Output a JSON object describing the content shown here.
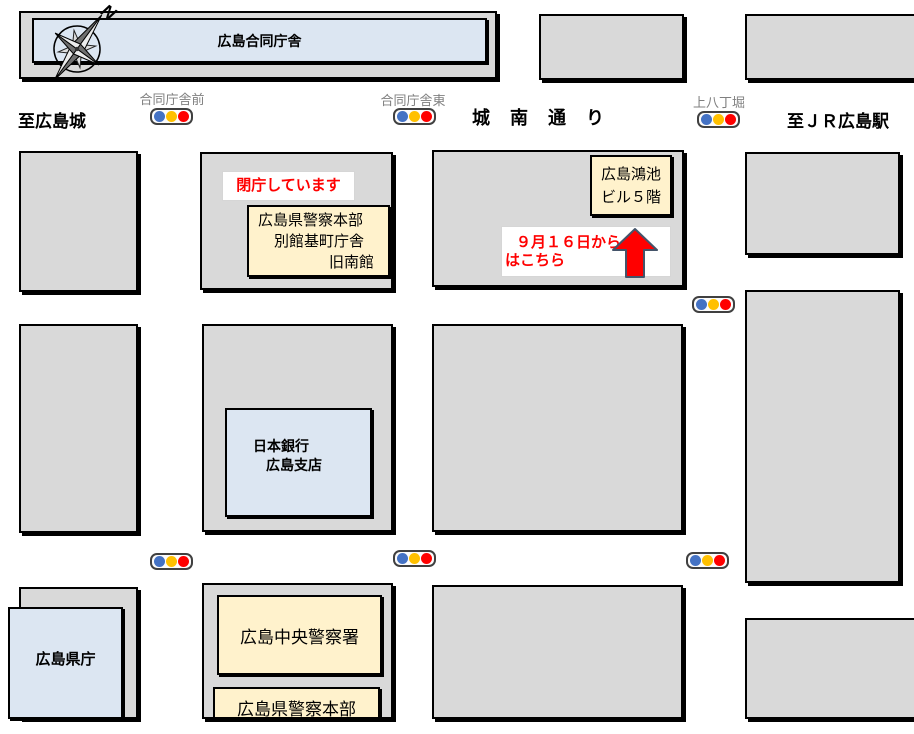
{
  "compass": {
    "north": "N"
  },
  "buildings": {
    "godochosha": "広島合同庁舎",
    "kyu_minamikan": {
      "line1": "広島県警察本部",
      "line2": "別館基町庁舎",
      "line3": "旧南館"
    },
    "konoike_bldg": {
      "line1": "広島鴻池",
      "line2": "ビル５階"
    },
    "nihon_ginko": {
      "line1": "日本銀行",
      "line2": "広島支店"
    },
    "kencho": "広島県庁",
    "chuo_keisatsusho": "広島中央警察署",
    "keisatsu_honbu": "広島県警察本部"
  },
  "notices": {
    "closed": "閉庁しています",
    "from_sep16_line1": "９月１６日から",
    "from_sep16_line2": "はこちら"
  },
  "roads": {
    "to_hiroshima_castle": "至広島城",
    "jonan_dori": "城　南　通　り",
    "to_jr_hiroshima_sta": "至ＪＲ広島駅"
  },
  "signals": {
    "godochosha_mae": "合同庁舎前",
    "godochosha_higashi": "合同庁舎東",
    "kami_hatchobori": "上八丁堀"
  },
  "colors": {
    "block_gray": "#d9d9d9",
    "box_blue": "#dce6f2",
    "box_cream": "#fff2cc",
    "signal_blue": "#4472c4",
    "signal_yellow": "#ffc000",
    "signal_red": "#ff0000",
    "notice_red": "#ff0000",
    "label_gray": "#7f7f7f",
    "arrow_red": "#ff0000",
    "arrow_outline": "#44546a"
  }
}
